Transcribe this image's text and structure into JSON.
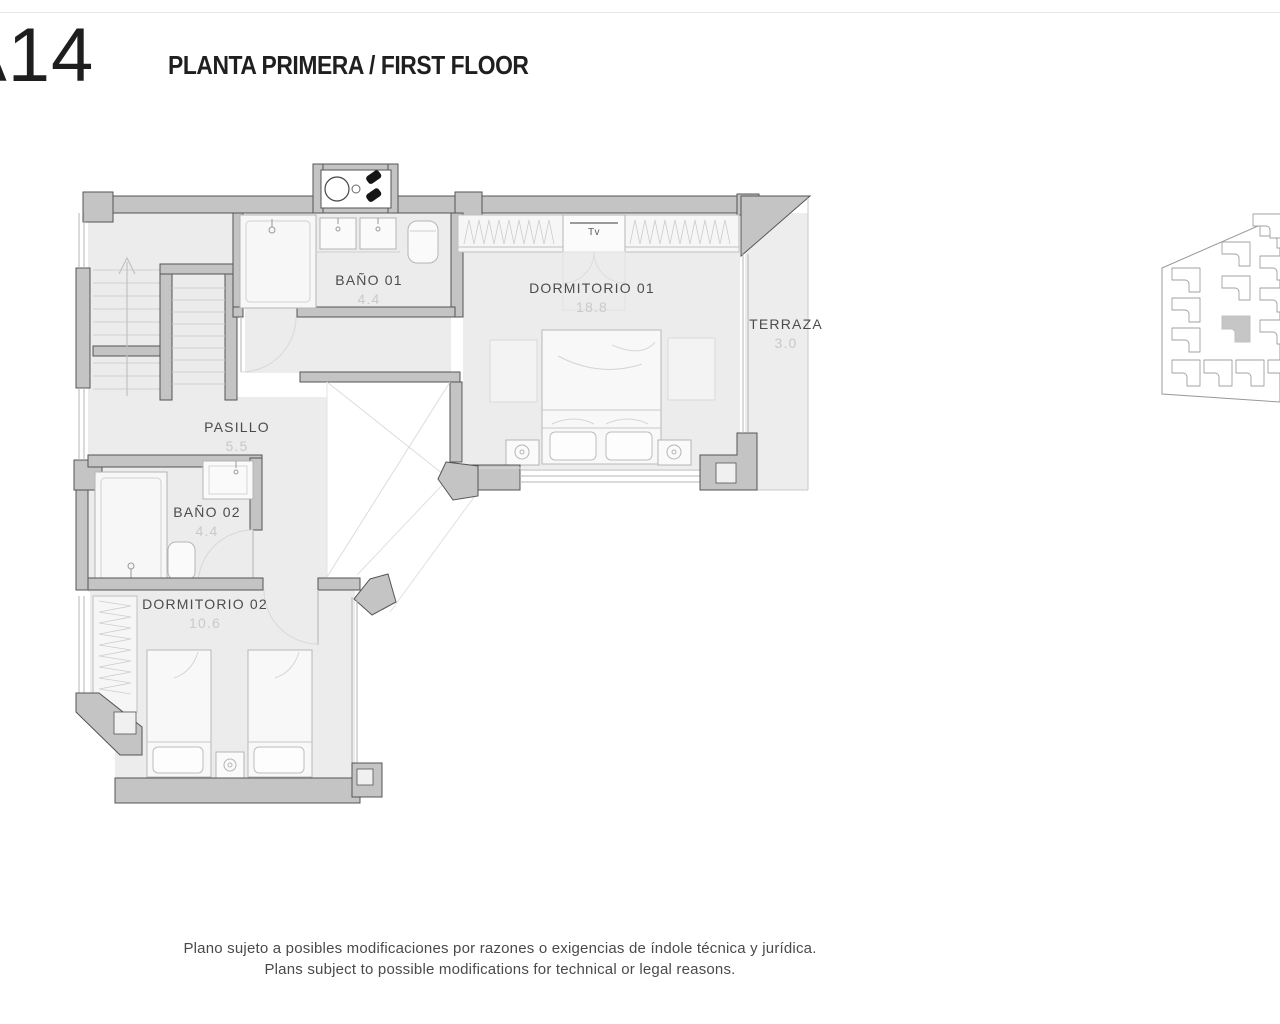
{
  "header": {
    "unit_code": "A14",
    "title": "PLANTA PRIMERA / FIRST FLOOR"
  },
  "rooms": [
    {
      "id": "bano-01",
      "name": "BAÑO 01",
      "area": "4.4"
    },
    {
      "id": "dormitorio-01",
      "name": "DORMITORIO 01",
      "area": "18.8"
    },
    {
      "id": "terraza",
      "name": "TERRAZA",
      "area": "3.0"
    },
    {
      "id": "pasillo",
      "name": "PASILLO",
      "area": "5.5"
    },
    {
      "id": "bano-02",
      "name": "BAÑO 02",
      "area": "4.4"
    },
    {
      "id": "dormitorio-02",
      "name": "DORMITORIO 02",
      "area": "10.6"
    }
  ],
  "furniture": {
    "tv": "Tv"
  },
  "key_plan": {
    "units_visible": 15,
    "highlighted_units": 1
  },
  "colors": {
    "wall_fill": "#c4c4c4",
    "wall_stroke": "#555555",
    "floor": "#ececec",
    "highlight_unit": "#c6c6c6",
    "label": "#4c4c4c",
    "area_value": "#c9c9c9"
  },
  "footer": {
    "line1_es": "Plano sujeto a posibles modificaciones por razones o exigencias de índole técnica y jurídica.",
    "line2_en": "Plans subject to possible modifications for technical or legal reasons."
  }
}
